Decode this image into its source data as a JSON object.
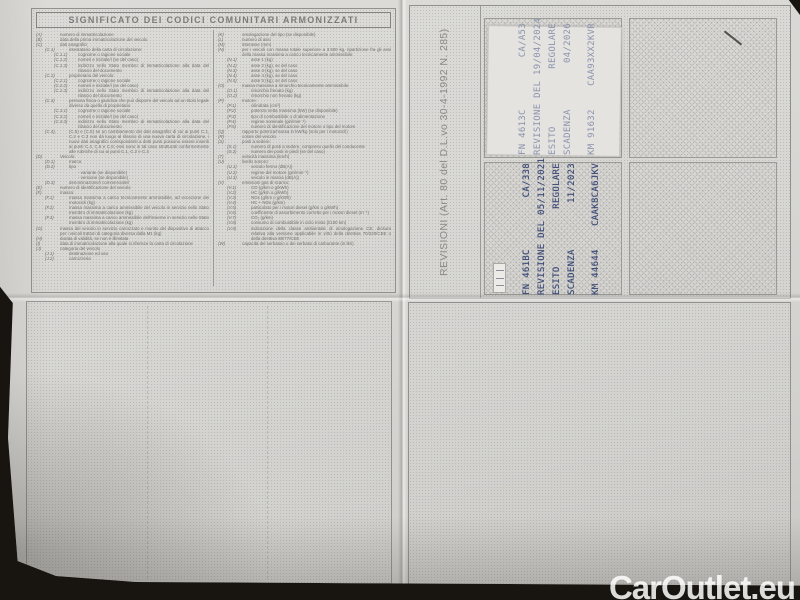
{
  "watermark": "CarOutlet.eu",
  "colors": {
    "photo-bg": "#18140f",
    "paper": "#d7d6d3",
    "print-ink": "#6f6f6c",
    "stamp-ink": "#3d4a75",
    "stamp-ink-faint": "#8b93ad",
    "watermark": "#ffffff"
  },
  "legend": {
    "title": "SIGNIFICATO DEI CODICI COMUNITARI ARMONIZZATI",
    "left": [
      {
        "i": 0,
        "c": "(A)",
        "t": "numero di immatricolazione"
      },
      {
        "i": 0,
        "c": "(B)",
        "t": "data della prima immatricolazione del veicolo"
      },
      {
        "i": 0,
        "c": "(C)",
        "t": "dati anagrafici"
      },
      {
        "i": 1,
        "c": "(C.1)",
        "t": "intestatario della carta di circolazione:"
      },
      {
        "i": 2,
        "c": "(C.1.1)",
        "t": "cognome o ragione sociale"
      },
      {
        "i": 2,
        "c": "(C.1.2)",
        "t": "nome/i e iniziale/i (se del caso)"
      },
      {
        "i": 2,
        "c": "(C.1.3)",
        "t": "indirizzo nello Stato membro di immatricolazione alla data del rilascio del documento"
      },
      {
        "i": 1,
        "c": "(C.2)",
        "t": "proprietario del veicolo:"
      },
      {
        "i": 2,
        "c": "(C.2.1)",
        "t": "cognome o ragione sociale"
      },
      {
        "i": 2,
        "c": "(C.2.2)",
        "t": "nome/i e iniziale/i (se del caso)"
      },
      {
        "i": 2,
        "c": "(C.2.3)",
        "t": "indirizzo nello Stato membro di immatricolazione alla data del rilascio del documento"
      },
      {
        "i": 1,
        "c": "(C.3)",
        "t": "persona fisica o giuridica che può disporre del veicolo ad un titolo legale diverso da quello di proprietario"
      },
      {
        "i": 2,
        "c": "(C.3.1)",
        "t": "cognome o ragione sociale"
      },
      {
        "i": 2,
        "c": "(C.3.2)",
        "t": "nome/i e iniziale/i (se del caso)"
      },
      {
        "i": 2,
        "c": "(C.3.3)",
        "t": "indirizzo nello Stato membro di immatricolazione alla data del rilascio del documento"
      },
      {
        "i": 1,
        "c": "(C.4),",
        "t": "(C.5) e (C.6) se un cambiamento dei dati anagrafici di cui ai punti C.1, C.2 e C.3 non dà luogo al rilascio di una nuova carta di circolazione, i nuovi dati anagrafici corrispondenti a detti punti possono essere inseriti ai punti C.4, C.5 e C.6; essi sono in tal caso strutturati conformemente alle rubriche di cui ai punti C.1, C.2 e C.3"
      },
      {
        "i": 0,
        "c": "(D)",
        "t": "Veicolo:"
      },
      {
        "i": 1,
        "c": "(D.1)",
        "t": "marca"
      },
      {
        "i": 1,
        "c": "(D.2)",
        "t": "tipo"
      },
      {
        "i": 2,
        "c": "",
        "t": "- variante (se disponibile)"
      },
      {
        "i": 2,
        "c": "",
        "t": "- versione (se disponibile)"
      },
      {
        "i": 1,
        "c": "(D.3)",
        "t": "denominazione/i commerciale/i"
      },
      {
        "i": 0,
        "c": "(E)",
        "t": "numero di identificazione del veicolo"
      },
      {
        "i": 0,
        "c": "(F)",
        "t": "massa:"
      },
      {
        "i": 1,
        "c": "(F.1)",
        "t": "massa massima a carico tecnicamente ammissibile, ad eccezione dei motocicli (kg)"
      },
      {
        "i": 1,
        "c": "(F.2)",
        "t": "massa massima a carico ammissibile del veicolo in servizio nello Stato membro di immatricolazione (kg)"
      },
      {
        "i": 1,
        "c": "(F.3)",
        "t": "massa massima a carico ammissibile dell'insieme in servizio nello Stato membro di immatricolazione (kg)"
      },
      {
        "i": 0,
        "c": "(G)",
        "t": "massa del veicolo in servizio carrozzato e munito del dispositivo di attacco per i veicoli trattori di categoria diversa dalla M1 (kg)"
      },
      {
        "i": 0,
        "c": "(H)",
        "t": "durata di validità, se non è illimitata"
      },
      {
        "i": 0,
        "c": "(I)",
        "t": "data di immatricolazione alla quale si riferisce la carta di circolazione"
      },
      {
        "i": 0,
        "c": "(J)",
        "t": "categoria del veicolo"
      },
      {
        "i": 1,
        "c": "(J.1)",
        "t": "destinazione ed uso"
      },
      {
        "i": 1,
        "c": "(J.2)",
        "t": "carrozzeria"
      }
    ],
    "right": [
      {
        "i": 0,
        "c": "(K)",
        "t": "omologazione del tipo (se disponibile)"
      },
      {
        "i": 0,
        "c": "(L)",
        "t": "numero di assi"
      },
      {
        "i": 0,
        "c": "(M)",
        "t": "interasse (mm)"
      },
      {
        "i": 0,
        "c": "(N)",
        "t": "per i veicoli con massa totale superiore a 3.500 kg, ripartizione fra gli assi della massa massima a carico tecnicamente ammissibile:"
      },
      {
        "i": 1,
        "c": "(N.1)",
        "t": "asse 1 (kg)"
      },
      {
        "i": 1,
        "c": "(N.2)",
        "t": "asse 2 (kg), se del caso"
      },
      {
        "i": 1,
        "c": "(N.3)",
        "t": "asse 3 (kg), se del caso"
      },
      {
        "i": 1,
        "c": "(N.4)",
        "t": "asse 4 (kg), se del caso"
      },
      {
        "i": 1,
        "c": "(N.5)",
        "t": "asse 5 (kg), se del caso"
      },
      {
        "i": 0,
        "c": "(O)",
        "t": "massa massima a rimorchio tecnicamente ammissibile:"
      },
      {
        "i": 1,
        "c": "(O.1)",
        "t": "rimorchio frenato (kg)"
      },
      {
        "i": 1,
        "c": "(O.2)",
        "t": "rimorchio non frenato (kg)"
      },
      {
        "i": 0,
        "c": "(P)",
        "t": "motore:"
      },
      {
        "i": 1,
        "c": "(P.1)",
        "t": "cilindrata (cm³)"
      },
      {
        "i": 1,
        "c": "(P.2)",
        "t": "potenza netta massima (kW) (se disponibile)"
      },
      {
        "i": 1,
        "c": "(P.3)",
        "t": "tipo di combustibile o di alimentazione"
      },
      {
        "i": 1,
        "c": "(P.4)",
        "t": "regime nominale (giri/min⁻¹)"
      },
      {
        "i": 1,
        "c": "(P.5)",
        "t": "numero di identificazione del motore o tipo del motore"
      },
      {
        "i": 0,
        "c": "(Q)",
        "t": "rapporto potenza/massa in kW/kg (solo per i motocicli)"
      },
      {
        "i": 0,
        "c": "(R)",
        "t": "colore del veicolo"
      },
      {
        "i": 0,
        "c": "(S)",
        "t": "posti a sedere:"
      },
      {
        "i": 1,
        "c": "(S.1)",
        "t": "numero di posti a sedere, compreso quello del conducente"
      },
      {
        "i": 1,
        "c": "(S.2)",
        "t": "numero dei posti in piedi (se del caso)"
      },
      {
        "i": 0,
        "c": "(T)",
        "t": "velocità massima (km/h)"
      },
      {
        "i": 0,
        "c": "(U)",
        "t": "livello sonoro:"
      },
      {
        "i": 1,
        "c": "(U.1)",
        "t": "veicolo fermo (dB(A))"
      },
      {
        "i": 1,
        "c": "(U.2)",
        "t": "regime del motore (giri/min⁻¹)"
      },
      {
        "i": 1,
        "c": "(U.3)",
        "t": "veicolo in marcia (dB(A))"
      },
      {
        "i": 0,
        "c": "(V)",
        "t": "emissioni gas di scarico:"
      },
      {
        "i": 1,
        "c": "(V.1)",
        "t": "CO (g/km o g/kWh)"
      },
      {
        "i": 1,
        "c": "(V.2)",
        "t": "HC (g/km o g/kWh)"
      },
      {
        "i": 1,
        "c": "(V.3)",
        "t": "NOx (g/km o g/kWh)"
      },
      {
        "i": 1,
        "c": "(V.4)",
        "t": "HC + NOx (g/km)"
      },
      {
        "i": 1,
        "c": "(V.5)",
        "t": "particolato per i motori diesel (g/km o g/kWh)"
      },
      {
        "i": 1,
        "c": "(V.6)",
        "t": "coefficiente di assorbimento corretto per i motori diesel (m⁻¹)"
      },
      {
        "i": 1,
        "c": "(V.7)",
        "t": "CO₂ (g/km)"
      },
      {
        "i": 1,
        "c": "(V.8)",
        "t": "consumo di combustibile in ciclo misto (l/100 km)"
      },
      {
        "i": 1,
        "c": "(V.9)",
        "t": "indicazione della classe ambientale di omologazione CE; dicitura relativa alla versione applicabile in virtù della direttiva 70/220/CEE o della direttiva 88/77/CEE"
      },
      {
        "i": 0,
        "c": "(W)",
        "t": "capacità del serbatoio o dei serbatoi di carburante (in litri)"
      }
    ]
  },
  "revision": {
    "side_label": "REVISIONI (Art. 80 del D.L.vo 30-4-1992 N. 285)",
    "stamp_top": {
      "lines": [
        {
          "l": "FN 4613C",
          "r": "CA/A53"
        },
        {
          "l": "REVISIONE DEL 19/04/2024",
          "r": ""
        },
        {
          "l": "ESITO",
          "r": "REGOLARE"
        },
        {
          "l": "SCADENZA",
          "r": "04/2026"
        },
        {
          "l": "KM 91632",
          "r": "CAA93XX2KVR"
        }
      ]
    },
    "stamp_bottom": {
      "lines": [
        {
          "l": "FN 461BC",
          "r": "CA/338"
        },
        {
          "l": "REVISIONE DEL 05/11/2021",
          "r": ""
        },
        {
          "l": "ESITO",
          "r": "REGOLARE"
        },
        {
          "l": "SCADENZA",
          "r": "11/2023"
        },
        {
          "l": "KM 44644",
          "r": "CAAK8CA6JKV"
        }
      ]
    }
  }
}
